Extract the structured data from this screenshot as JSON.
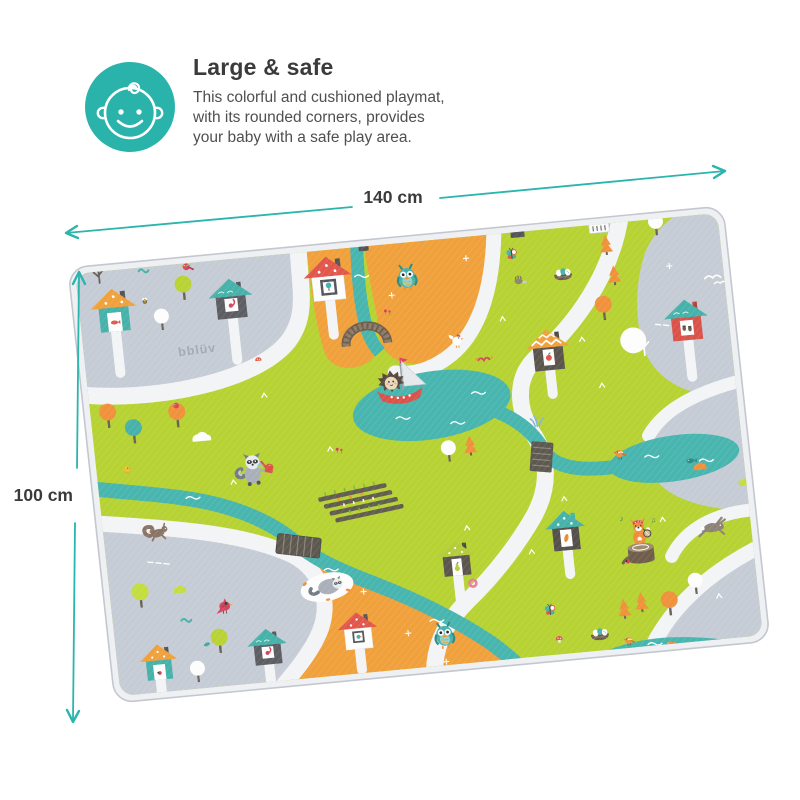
{
  "header": {
    "title": "Large & safe",
    "description": [
      "This colorful and cushioned playmat,",
      "with its rounded corners, provides",
      "your baby with a safe play area."
    ],
    "icon": "baby-face-icon",
    "icon_color": "#29b3ab"
  },
  "dimensions": {
    "width_label": "140 cm",
    "height_label": "100 cm",
    "arrow_color": "#2ab5ad",
    "label_color": "#3a3a3a"
  },
  "mat": {
    "brand_logo": "bblüv",
    "colors": {
      "green": "#b7d233",
      "orange": "#f0a13c",
      "gray": "#c6ccd5",
      "water": "#48b5af",
      "road": "#f3f4f6",
      "rim": "#eef0f3",
      "house_red": "#e2574c",
      "house_teal": "#46b2aa"
    },
    "scene_items": [
      "village roads",
      "rivers and ponds",
      "hedgehog sailing a red boat",
      "owl in orange field",
      "owl near bottom houses",
      "raccoon watering a vegetable garden",
      "sleeping raccoon in clearing",
      "fox playing banjo on a tree stump",
      "leaping rabbit",
      "running squirrel",
      "cardinal",
      "white hen",
      "yellow chick",
      "white doves",
      "orange birds",
      "fish",
      "bird nests with eggs",
      "butterflies",
      "arched bridge",
      "plank bridge",
      "road bridge",
      "houses with fish, squirrel, tree, acorns, apple, bird, pear and leaf doors",
      "trees, pines and bushes",
      "mushrooms"
    ]
  }
}
